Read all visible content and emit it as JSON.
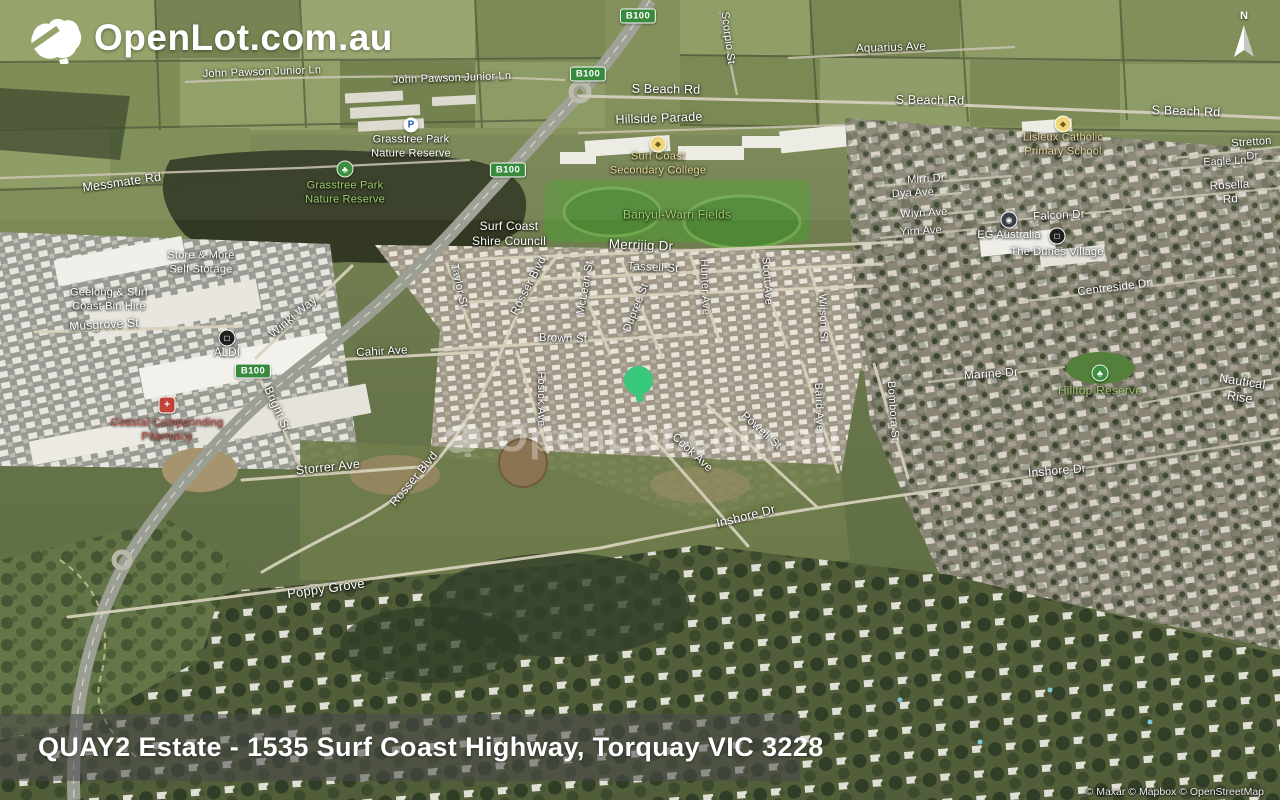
{
  "header": {
    "logo_text": "OpenLot.com.au",
    "compass_label": "N"
  },
  "watermark": {
    "text": "OpenLot.com.au"
  },
  "footer": {
    "caption": "QUAY2 Estate - 1535 Surf Coast Highway, Torquay VIC 3228",
    "attribution": "© Maxar © Mapbox © OpenStreetMap"
  },
  "colors": {
    "pin": "#38c97c",
    "shield_bg": "#398a3c",
    "park_label": "#9fcb6a",
    "school_label": "#e8d795",
    "health_label": "#cc544a"
  },
  "map": {
    "pin": {
      "x": 639,
      "y": 381
    },
    "shields": [
      {
        "label": "B100",
        "x": 638,
        "y": 16
      },
      {
        "label": "B100",
        "x": 588,
        "y": 74
      },
      {
        "label": "B100",
        "x": 508,
        "y": 170
      },
      {
        "label": "B100",
        "x": 253,
        "y": 371
      }
    ],
    "labels": [
      {
        "text": "John Pawson Junior Ln",
        "x": 262,
        "y": 73,
        "rot": -2,
        "kind": "road"
      },
      {
        "text": "John Pawson Junior Ln",
        "x": 452,
        "y": 79,
        "rot": -2,
        "kind": "road"
      },
      {
        "text": "S Beach Rd",
        "x": 666,
        "y": 90,
        "rot": 1,
        "size": 12.5,
        "kind": "road"
      },
      {
        "text": "S Beach Rd",
        "x": 930,
        "y": 101,
        "rot": 1,
        "size": 12.5,
        "kind": "road"
      },
      {
        "text": "S Beach Rd",
        "x": 1186,
        "y": 112,
        "rot": 2,
        "size": 12.5,
        "kind": "road"
      },
      {
        "text": "Scorpio St",
        "x": 727,
        "y": 38,
        "rot": 83,
        "kind": "road"
      },
      {
        "text": "Aquarius Ave",
        "x": 891,
        "y": 48,
        "rot": -2,
        "size": 11.5,
        "kind": "road"
      },
      {
        "text": "Hillside Parade",
        "x": 659,
        "y": 119,
        "rot": -2,
        "size": 12.5,
        "kind": "road"
      },
      {
        "text": "Messmate Rd",
        "x": 122,
        "y": 183,
        "rot": -8,
        "size": 12.5,
        "kind": "road"
      },
      {
        "text": "Musgrove St",
        "x": 104,
        "y": 325,
        "rot": -3,
        "size": 12,
        "kind": "road"
      },
      {
        "text": "Winki Way",
        "x": 293,
        "y": 317,
        "rot": -40,
        "size": 12,
        "kind": "road"
      },
      {
        "text": "Bright St",
        "x": 277,
        "y": 409,
        "rot": 66,
        "size": 12,
        "kind": "road"
      },
      {
        "text": "Cahir Ave",
        "x": 382,
        "y": 352,
        "rot": -3,
        "size": 11.5,
        "kind": "road"
      },
      {
        "text": "Taylor St",
        "x": 458,
        "y": 286,
        "rot": 77,
        "kind": "road"
      },
      {
        "text": "Rosser Blvd",
        "x": 529,
        "y": 286,
        "rot": -63,
        "size": 11.5,
        "kind": "road"
      },
      {
        "text": "McLean St",
        "x": 586,
        "y": 288,
        "rot": -80,
        "kind": "road"
      },
      {
        "text": "Dupree St",
        "x": 637,
        "y": 308,
        "rot": -68,
        "kind": "road"
      },
      {
        "text": "Hunter Ave",
        "x": 704,
        "y": 287,
        "rot": 88,
        "kind": "road"
      },
      {
        "text": "Scott Ave",
        "x": 766,
        "y": 281,
        "rot": 86,
        "kind": "road"
      },
      {
        "text": "Wilson St",
        "x": 822,
        "y": 318,
        "rot": 88,
        "kind": "road"
      },
      {
        "text": "Baird Ave",
        "x": 818,
        "y": 407,
        "rot": 88,
        "kind": "road"
      },
      {
        "text": "Bombora St",
        "x": 892,
        "y": 411,
        "rot": 86,
        "kind": "road"
      },
      {
        "text": "Powell St",
        "x": 761,
        "y": 431,
        "rot": 42,
        "size": 11.5,
        "kind": "road"
      },
      {
        "text": "Cook Ave",
        "x": 692,
        "y": 453,
        "rot": 43,
        "size": 11.5,
        "kind": "road"
      },
      {
        "text": "Fosick Ave",
        "x": 540,
        "y": 399,
        "rot": 90,
        "kind": "road"
      },
      {
        "text": "Brown St",
        "x": 563,
        "y": 339,
        "rot": 2,
        "size": 11.5,
        "kind": "road"
      },
      {
        "text": "Tassell St",
        "x": 653,
        "y": 268,
        "rot": 3,
        "size": 11.5,
        "kind": "road"
      },
      {
        "text": "Merrijig Dr",
        "x": 641,
        "y": 246,
        "rot": 2,
        "size": 13.5,
        "kind": "road"
      },
      {
        "text": "Mirri Dr",
        "x": 926,
        "y": 180,
        "rot": -3,
        "kind": "road"
      },
      {
        "text": "Dya Ave",
        "x": 913,
        "y": 194,
        "rot": -3,
        "kind": "road"
      },
      {
        "text": "Wiyn Ave",
        "x": 924,
        "y": 214,
        "rot": -3,
        "kind": "road"
      },
      {
        "text": "Yirn Ave",
        "x": 921,
        "y": 232,
        "rot": -3,
        "kind": "road"
      },
      {
        "text": "Falcon Dr",
        "x": 1059,
        "y": 216,
        "rot": -3,
        "size": 11.5,
        "kind": "road"
      },
      {
        "text": "Centreside Dr",
        "x": 1114,
        "y": 288,
        "rot": -7,
        "size": 11.5,
        "kind": "road"
      },
      {
        "text": "Stretton Dr",
        "x": 1252,
        "y": 150,
        "rot": -4,
        "kind": "road"
      },
      {
        "text": "Eagle Ln",
        "x": 1225,
        "y": 162,
        "rot": -3,
        "size": 10.5,
        "kind": "road"
      },
      {
        "text": "Rosella Rd",
        "x": 1230,
        "y": 193,
        "rot": -3,
        "size": 11.5,
        "kind": "road"
      },
      {
        "text": "Marine Dr",
        "x": 991,
        "y": 374,
        "rot": -4,
        "size": 12,
        "kind": "road"
      },
      {
        "text": "Nautical Rise",
        "x": 1241,
        "y": 390,
        "rot": 9,
        "size": 12.5,
        "kind": "road"
      },
      {
        "text": "Inshore Dr",
        "x": 1057,
        "y": 471,
        "rot": -5,
        "size": 12,
        "kind": "road"
      },
      {
        "text": "Inshore Dr",
        "x": 746,
        "y": 517,
        "rot": -14,
        "size": 12.5,
        "kind": "road"
      },
      {
        "text": "Storrer Ave",
        "x": 328,
        "y": 468,
        "rot": -6,
        "size": 12.5,
        "kind": "road"
      },
      {
        "text": "Rosser Blvd",
        "x": 414,
        "y": 479,
        "rot": -50,
        "size": 12,
        "kind": "road"
      },
      {
        "text": "Poppy Grove",
        "x": 326,
        "y": 589,
        "rot": -8,
        "size": 13,
        "kind": "road"
      },
      {
        "text": "Grasstree Park\nNature Reserve",
        "x": 411,
        "y": 147,
        "kind": "place"
      },
      {
        "text": "Grasstree Park\nNature Reserve",
        "x": 345,
        "y": 193,
        "kind": "park"
      },
      {
        "text": "Surf Coast\nSecondary College",
        "x": 658,
        "y": 164,
        "kind": "school"
      },
      {
        "text": "Banyul-Warri Fields",
        "x": 677,
        "y": 215,
        "size": 12,
        "kind": "park"
      },
      {
        "text": "Surf Coast\nShire Council",
        "x": 509,
        "y": 234,
        "size": 12,
        "kind": "place"
      },
      {
        "text": "Store & More\nSelf Storage",
        "x": 201,
        "y": 263,
        "kind": "place"
      },
      {
        "text": "Geelong & Surf\nCoast Bin Hire",
        "x": 109,
        "y": 300,
        "kind": "place"
      },
      {
        "text": "ALDI",
        "x": 227,
        "y": 353,
        "size": 11.5,
        "kind": "shop"
      },
      {
        "text": "Coastal Compounding\nPharmacy",
        "x": 167,
        "y": 430,
        "kind": "health"
      },
      {
        "text": "Lisieux Catholic\nPrimary School",
        "x": 1063,
        "y": 145,
        "kind": "school"
      },
      {
        "text": "EG Australia",
        "x": 1009,
        "y": 236,
        "kind": "shop"
      },
      {
        "text": "The Dunes Village",
        "x": 1057,
        "y": 253,
        "kind": "shop"
      },
      {
        "text": "Hilltop Reserve",
        "x": 1100,
        "y": 391,
        "size": 12,
        "kind": "park"
      }
    ],
    "pois": [
      {
        "icon": "parking",
        "x": 411,
        "y": 125
      },
      {
        "icon": "park",
        "x": 345,
        "y": 169
      },
      {
        "icon": "school",
        "x": 658,
        "y": 144
      },
      {
        "icon": "school",
        "x": 1063,
        "y": 124
      },
      {
        "icon": "supermarket",
        "x": 227,
        "y": 338
      },
      {
        "icon": "pharmacy",
        "x": 167,
        "y": 405
      },
      {
        "icon": "fuel",
        "x": 1009,
        "y": 220
      },
      {
        "icon": "shopping",
        "x": 1057,
        "y": 236
      },
      {
        "icon": "park",
        "x": 1100,
        "y": 373
      }
    ]
  }
}
